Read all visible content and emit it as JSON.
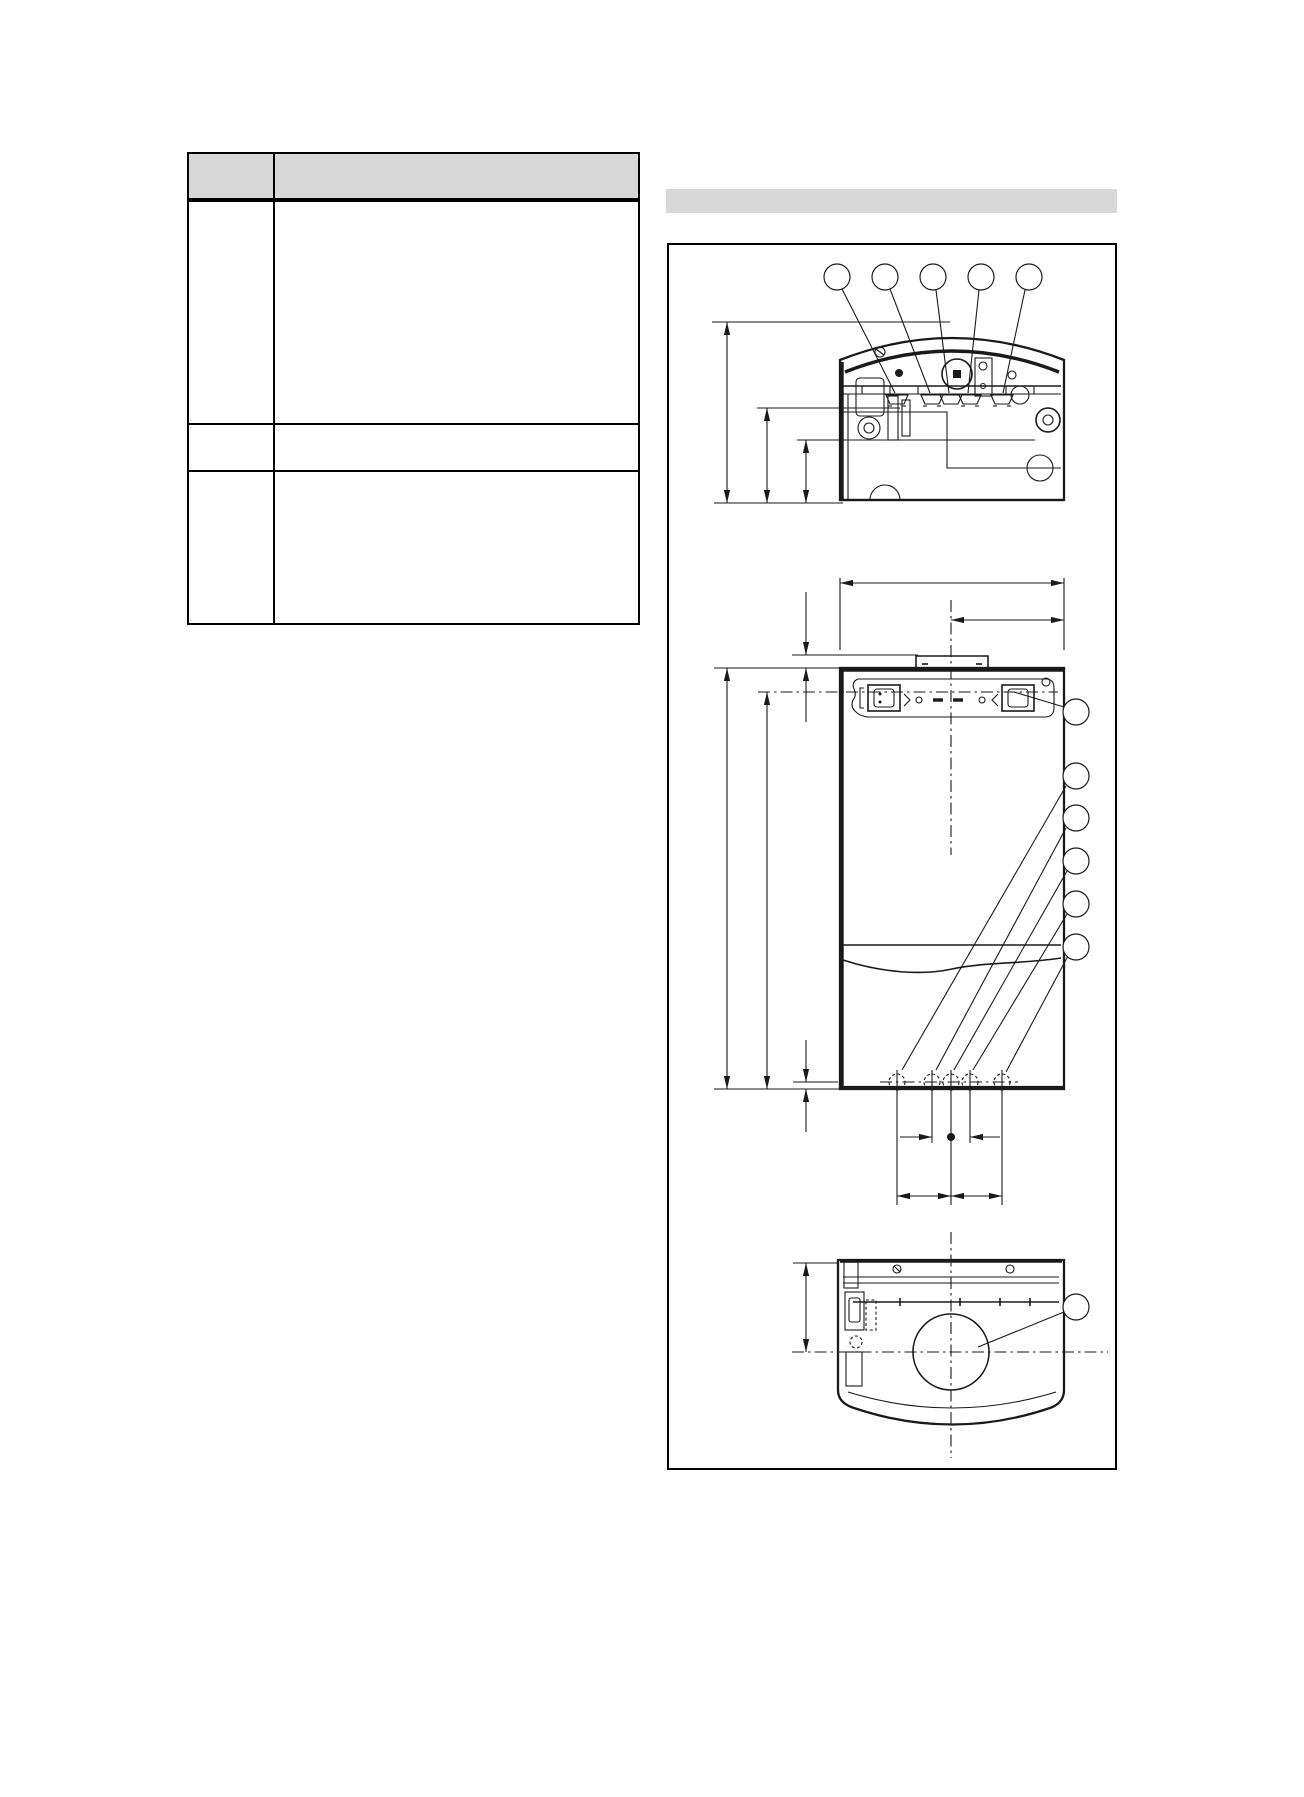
{
  "page": {
    "kind": "technical-manual-page",
    "background": "#ffffff",
    "line_color": "#1a1a1a",
    "accent_gray": "#d7d7d7"
  },
  "table": {
    "header_fill": "#d7d7d7",
    "columns": [
      "",
      ""
    ],
    "rows": [
      [
        "",
        ""
      ],
      [
        "",
        ""
      ],
      [
        "",
        ""
      ]
    ]
  },
  "section_bar": {
    "label": ""
  },
  "diagram": {
    "frame": "rectangular border",
    "views": {
      "top_view": {
        "description": "unit seen from above with curved front edge, five pipe stubs and three depth dimension lines",
        "callouts": [
          "",
          "",
          "",
          "",
          ""
        ]
      },
      "front_view": {
        "description": "unit front with mounting bracket, connection strip, door seam, five bottom connections, width and height dimension lines",
        "callouts": [
          "",
          "",
          "",
          "",
          "",
          ""
        ]
      },
      "bottom_view": {
        "description": "unit seen from below with central flue opening and offset dimension",
        "callouts": [
          ""
        ]
      }
    },
    "dimension_labels": []
  }
}
